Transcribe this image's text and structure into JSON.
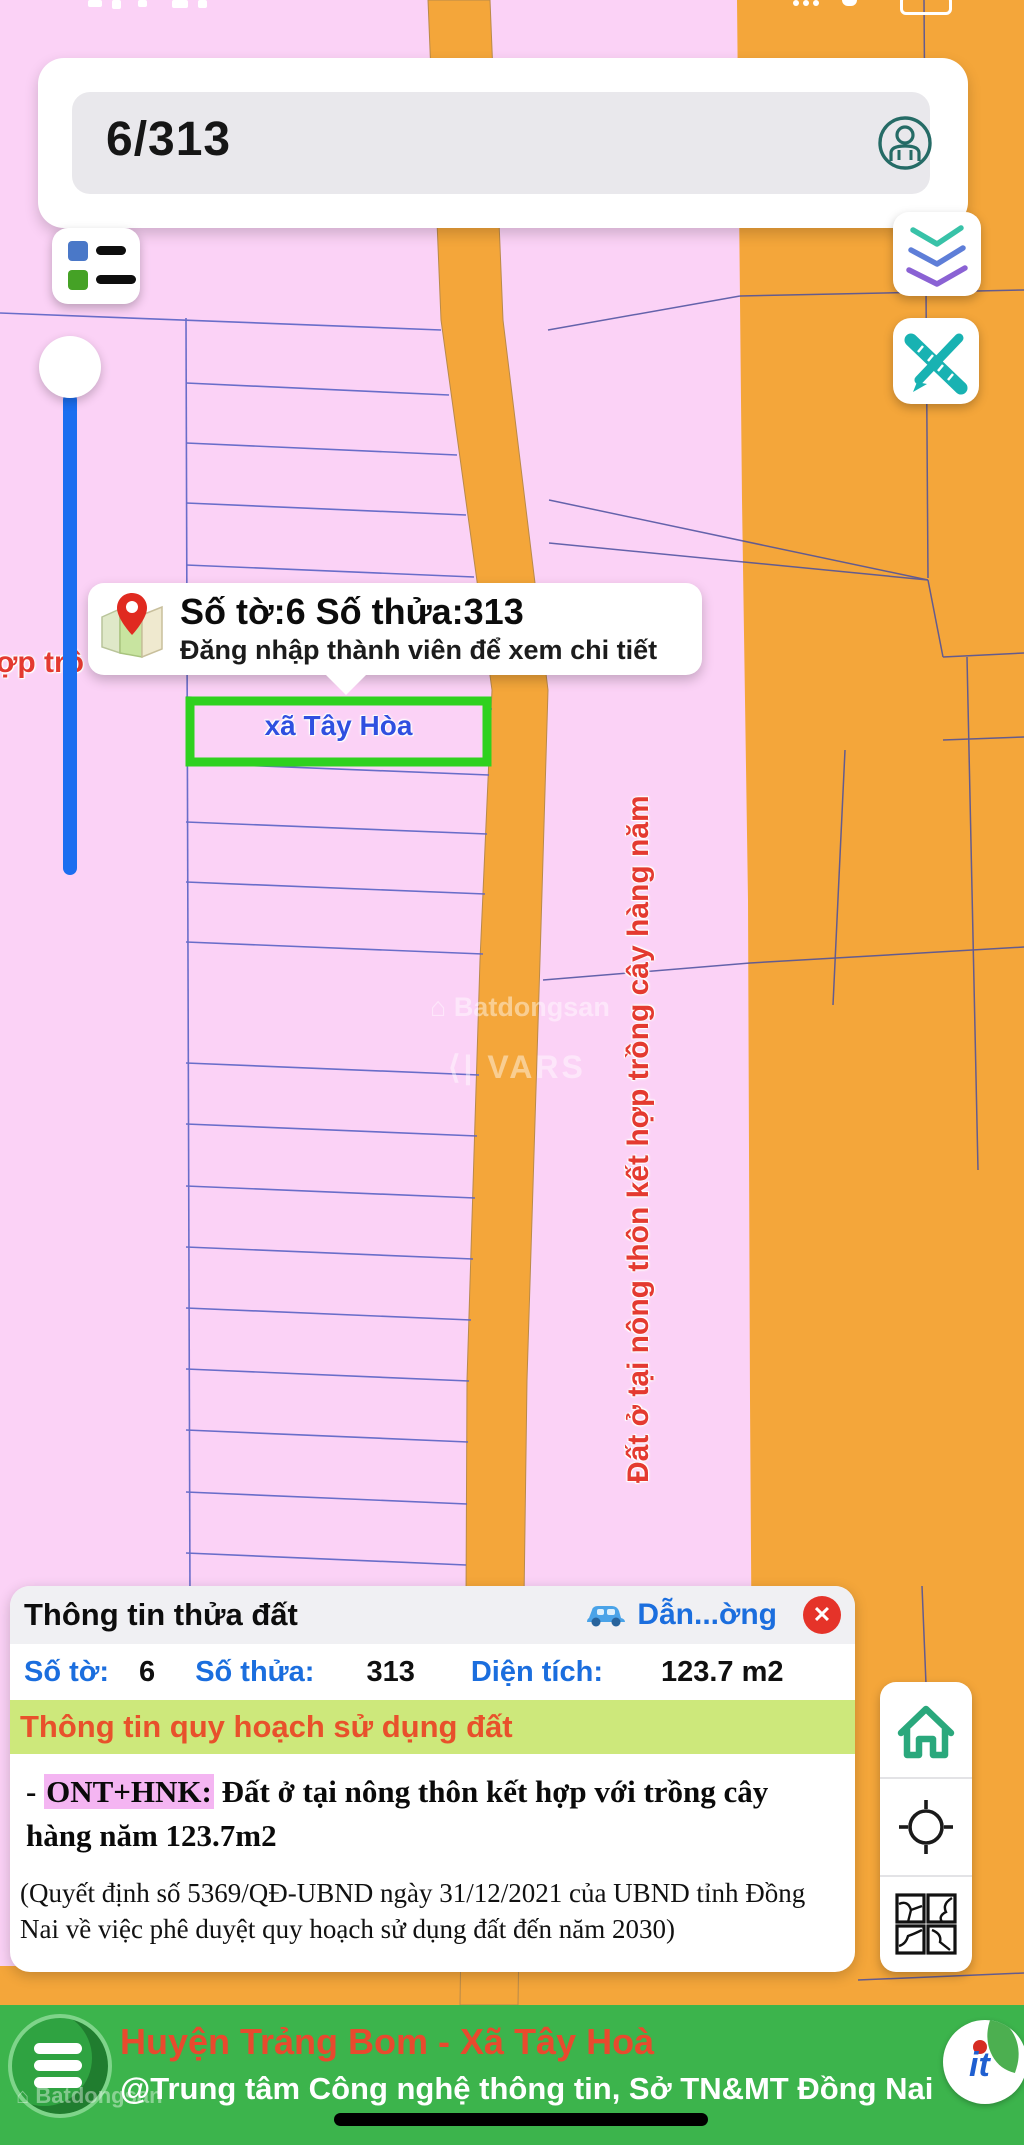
{
  "search": {
    "value": "6/313"
  },
  "map": {
    "tooltip": {
      "title": "Số tờ:6 Số thửa:313",
      "subtitle": "Đăng nhập thành viên để xem chi tiết"
    },
    "selected_parcel_label": "xã Tây Hòa",
    "left_edge_text": "ợp trồ",
    "zone_label_vertical": "Đất ở tại nông thôn kết hợp trồng cây hàng năm",
    "watermark_brand": "Batdongsan",
    "watermark_vars": "VARS",
    "colors": {
      "parcel_pink": "#fbd2f6",
      "road_orange": "#f4a63a",
      "boundary_blue": "#5a63c5",
      "selected_green": "#2fd11f",
      "marker_blue": "#1c6ef0"
    }
  },
  "info_panel": {
    "title": "Thông tin thửa đất",
    "direction_label": "Dẫn...ờng",
    "close_glyph": "✕",
    "fields": [
      {
        "label": "Số tờ:",
        "value": "6"
      },
      {
        "label": "Số thửa:",
        "value": "313"
      },
      {
        "label": "Diện tích:",
        "value": "123.7 m2"
      }
    ],
    "planning_header": "Thông tin quy hoạch sử dụng đất",
    "planning_dash": "- ",
    "planning_code": "ONT+HNK:",
    "planning_text": " Đất ở tại nông thôn kết hợp với trồng cây hàng năm 123.7m2",
    "decision_note": "(Quyết định số 5369/QĐ-UBND ngày 31/12/2021 của UBND tỉnh Đồng Nai về việc phê duyệt quy hoạch sử dụng đất đến năm 2030)"
  },
  "footer": {
    "line1": "Huyện Trảng Bom - Xã Tây Hoà",
    "line2": "@Trung tâm Công nghệ thông tin, Sở TN&MT Đồng Nai",
    "watermark": "Batdongsan"
  }
}
